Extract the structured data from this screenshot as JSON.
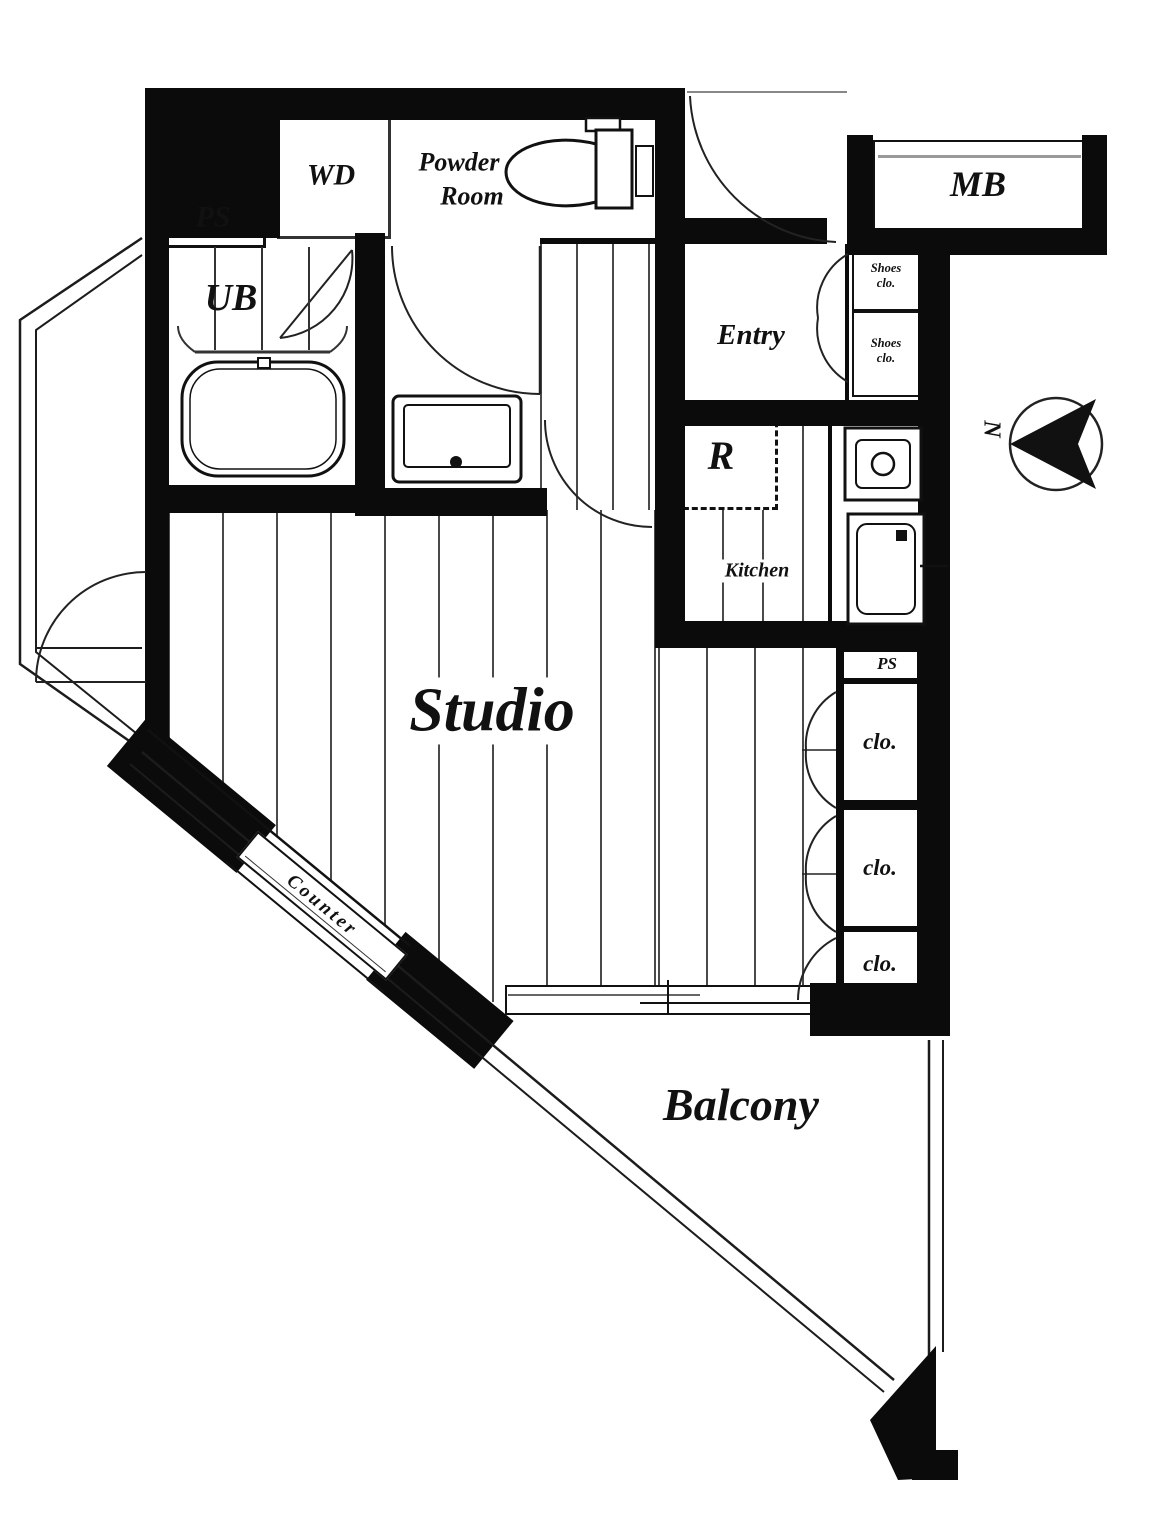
{
  "title": "Studio apartment floor plan",
  "labels": {
    "ps_top": "PS",
    "wd": "WD",
    "powder_line1": "Powder",
    "powder_line2": "Room",
    "ub": "UB",
    "mb": "MB",
    "entry": "Entry",
    "shoes_top_line1": "Shoes",
    "shoes_top_line2": "clo.",
    "shoes_bottom_line1": "Shoes",
    "shoes_bottom_line2": "clo.",
    "fridge": "R",
    "kitchen": "Kitchen",
    "ps_small": "PS",
    "clo_1": "clo.",
    "clo_2": "clo.",
    "clo_3": "clo.",
    "studio": "Studio",
    "counter": "Counter",
    "balcony": "Balcony",
    "north": "N"
  },
  "colors": {
    "wall": "#0b0b0b",
    "line": "#1c1c1c",
    "floor_line": "#4a4a4a",
    "background": "#ffffff"
  }
}
